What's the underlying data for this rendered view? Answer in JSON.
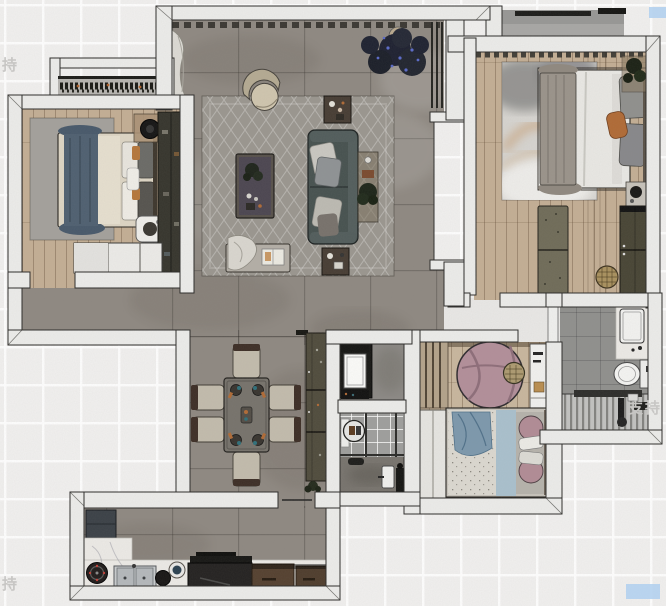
{
  "scene": "furnished-apartment-floor-plan-top-view",
  "watermarks": [
    {
      "text": "支持"
    },
    {
      "text": "支持"
    },
    {
      "text": "支持"
    }
  ],
  "palette": {
    "bg": "#f1f0ef",
    "grid": "#ffffff",
    "wall": "#ececea",
    "wall-line": "#2b2a28",
    "floor-tile": "#8e8881",
    "floor-wood": "#c3ae94",
    "floor-wood-2": "#c8b69d",
    "rug-living": "#9a968f",
    "rug-gray": "#a3a09b",
    "rug-pink": "#b28e99",
    "sofa": "#46514f",
    "navy": "#4e5f70",
    "orange": "#b06a35",
    "marble": "#eceae6",
    "bath-tile": "#8f8f8d",
    "cabinet-dark": "#35342c",
    "cabinet-olive": "#4f4b3c",
    "wood-brown": "#54402f",
    "watermark": "#c7c6c4",
    "highlight": "#b3d0ee"
  },
  "rooms": [
    {
      "id": "living-room"
    },
    {
      "id": "dining-area"
    },
    {
      "id": "kitchen"
    },
    {
      "id": "bedroom-left"
    },
    {
      "id": "bedroom-master"
    },
    {
      "id": "bedroom-second"
    },
    {
      "id": "bathroom-right"
    },
    {
      "id": "bathroom-middle"
    },
    {
      "id": "laundry-closet"
    },
    {
      "id": "balcony-left"
    },
    {
      "id": "balcony-top"
    },
    {
      "id": "hallway"
    }
  ]
}
